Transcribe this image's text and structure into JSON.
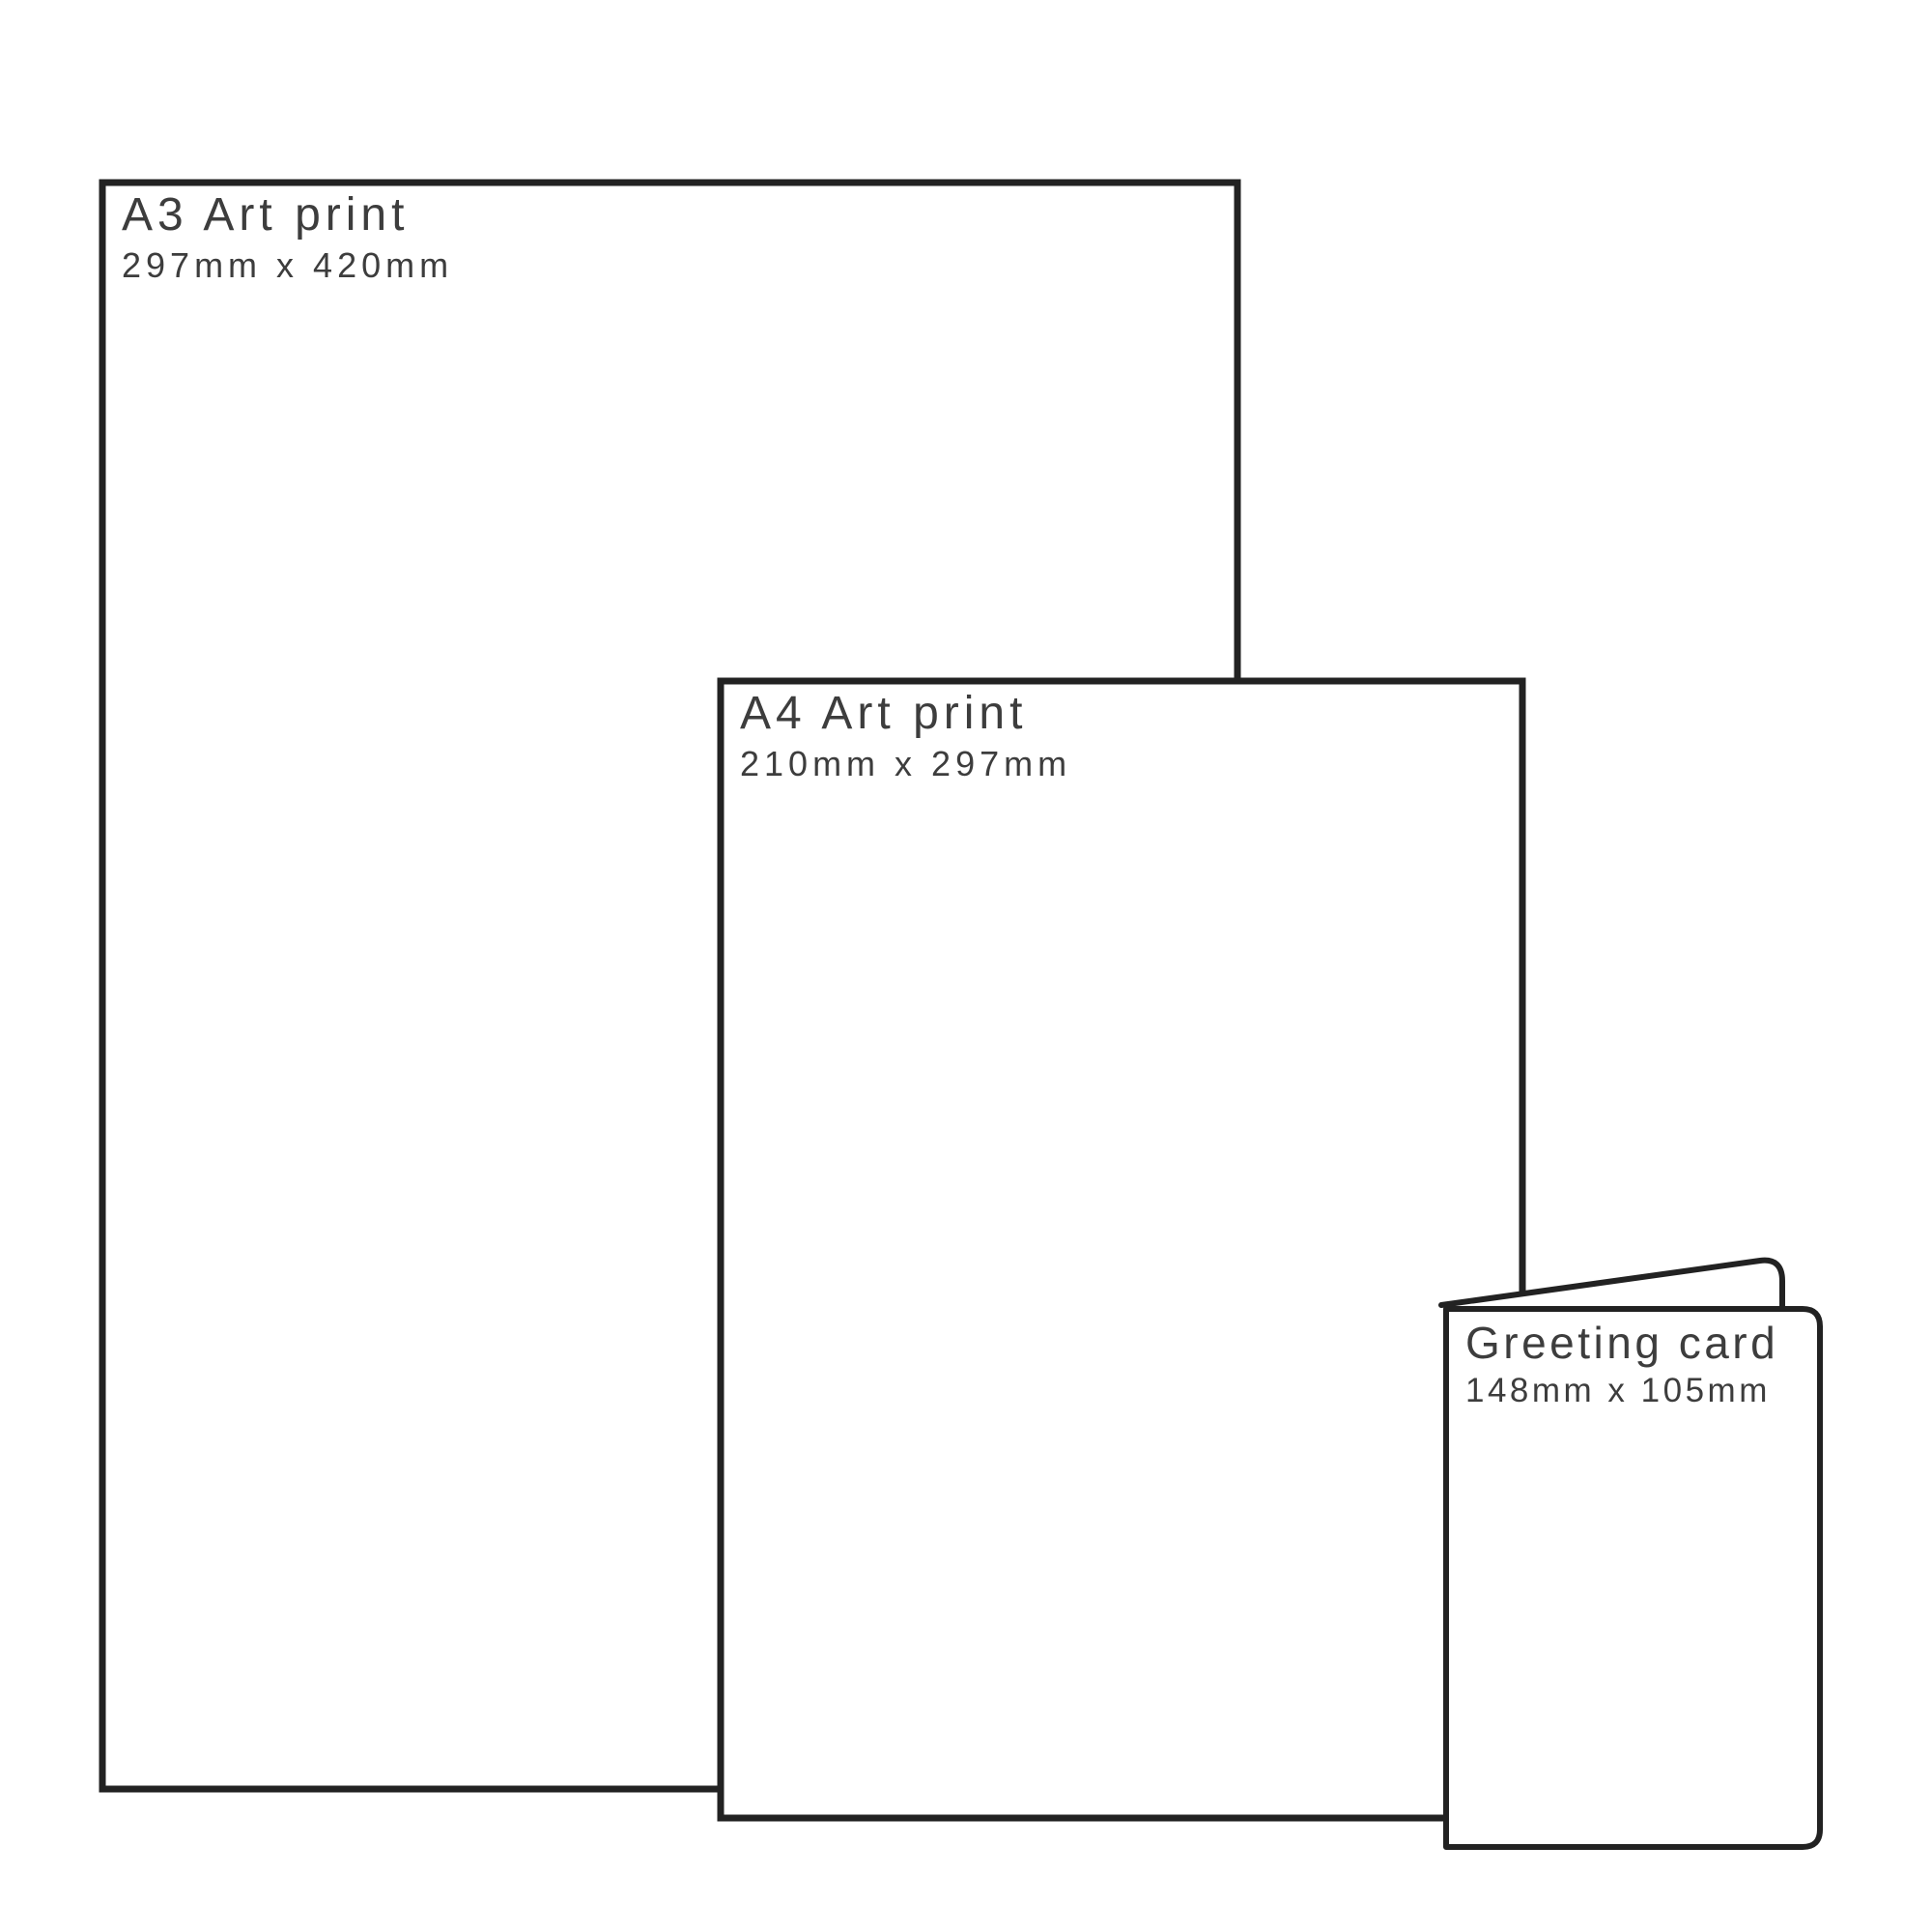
{
  "theme": {
    "background": "#ffffff",
    "line_color": "#222222",
    "text_color": "#3d3d3d"
  },
  "diagram": {
    "type": "print-size-comparison",
    "items": [
      {
        "name": "a3-print",
        "title": "A3 Art print",
        "dimensions": "297mm x 420mm"
      },
      {
        "name": "a4-print",
        "title": "A4 Art print",
        "dimensions": "210mm x 297mm"
      },
      {
        "name": "greeting-card",
        "title": "Greeting card",
        "dimensions": "148mm x 105mm"
      }
    ]
  }
}
